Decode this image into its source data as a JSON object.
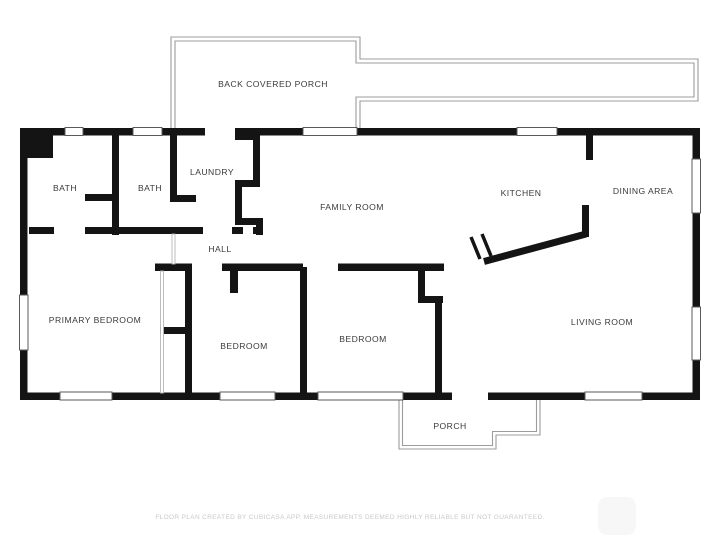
{
  "floorplan": {
    "rooms": [
      {
        "id": "back-covered-porch",
        "label": "BACK COVERED PORCH"
      },
      {
        "id": "bath-left",
        "label": "BATH"
      },
      {
        "id": "bath-middle",
        "label": "BATH"
      },
      {
        "id": "laundry",
        "label": "LAUNDRY"
      },
      {
        "id": "family-room",
        "label": "FAMILY ROOM"
      },
      {
        "id": "kitchen",
        "label": "KITCHEN"
      },
      {
        "id": "dining-area",
        "label": "DINING AREA"
      },
      {
        "id": "hall",
        "label": "HALL"
      },
      {
        "id": "primary-bedroom",
        "label": "PRIMARY BEDROOM"
      },
      {
        "id": "bedroom-middle",
        "label": "BEDROOM"
      },
      {
        "id": "bedroom-right",
        "label": "BEDROOM"
      },
      {
        "id": "living-room",
        "label": "LIVING ROOM"
      },
      {
        "id": "porch",
        "label": "PORCH"
      }
    ],
    "disclaimer": "FLOOR PLAN CREATED BY CUBICASA APP. MEASUREMENTS DEEMED HIGHLY RELIABLE BUT NOT GUARANTEED.",
    "colors": {
      "wall": "#141414",
      "outline": "#9c9c9c",
      "label_text": "#3a3a3a",
      "disclaimer_text": "#c9c9c9",
      "background": "#ffffff"
    }
  }
}
